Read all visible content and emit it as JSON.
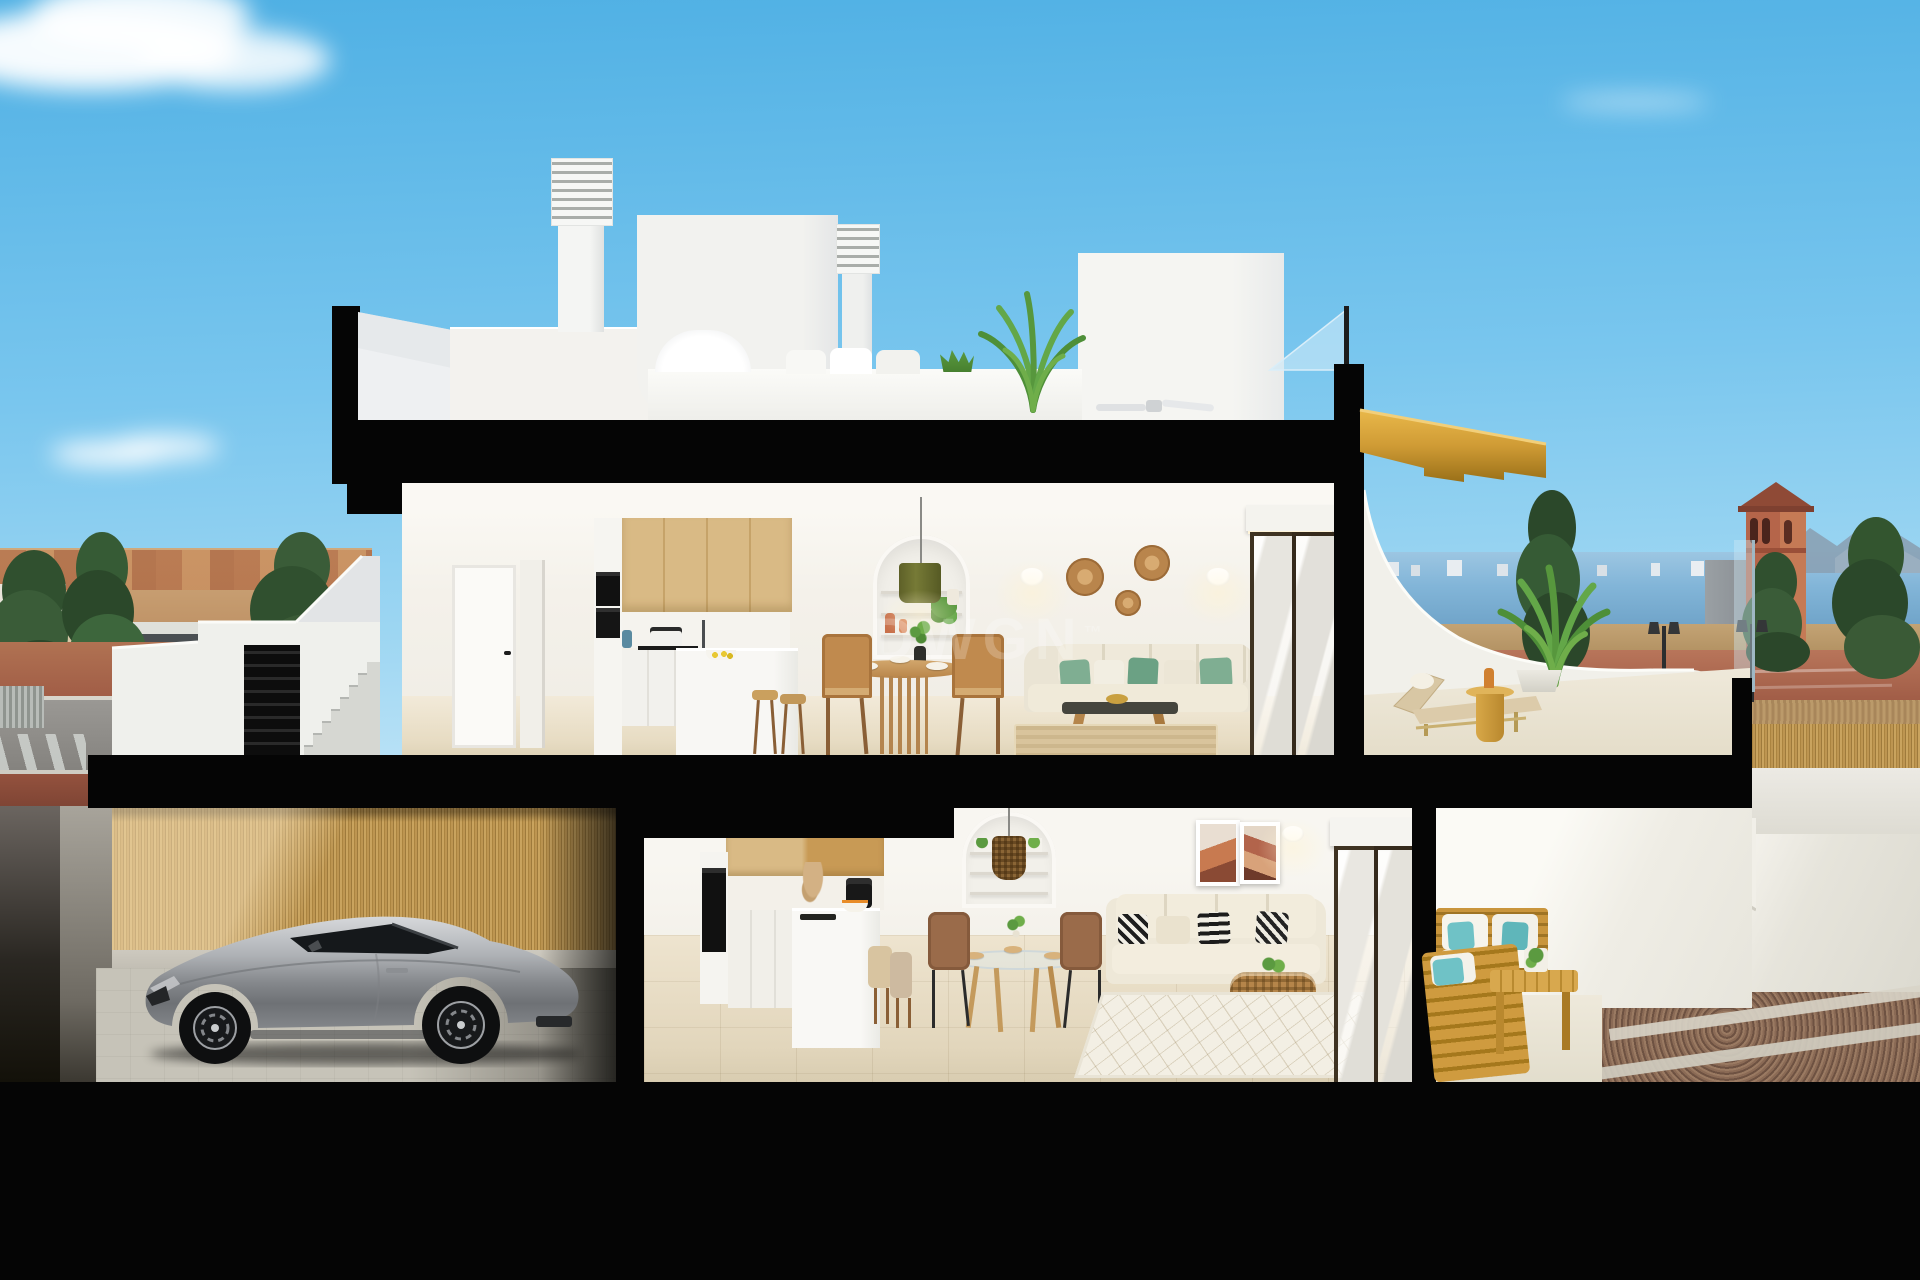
{
  "watermark": {
    "text": "DWGN",
    "tm": "™"
  },
  "palette": {
    "cut": "#050505",
    "sky-top": "#4fb0e4",
    "sky-mid": "#79c6ee",
    "sky-low": "#bfe4f7",
    "white": "#f3f2ee",
    "white-shade": "#e3e5e6",
    "wood": "#d9ba85",
    "gold": "#cf9b35",
    "gold-deep": "#a5781c",
    "floor-upper": "#ebe1cb",
    "floor-ground": "#e7dcc4",
    "garage-floor": "#c2bfb4",
    "sea": "#82b5d8",
    "town": "#c89a6c",
    "road-red": "#a05c46",
    "asphalt": "#94928e",
    "bamboo": "#c39a56",
    "teal": "#6fc2c6",
    "leaf": "#5b9a40",
    "terracotta": "#b2644b",
    "rattan": "#bd8a50",
    "car-silver": "#a7abaf"
  },
  "scene": {
    "type": "architectural-cutaway-render",
    "description": "Daylight cross-section render of a two-storey Mediterranean duplex: rooftop terrace with louvered chimneys, upper open-plan kitchen/dining/living with sun terrace and timber stair, ground-floor apartment with patio lounge, garage with silver sports coupe, coastal town, sea horizon and watchtower in the background",
    "levels": {
      "roof": [
        "louvered-chimney x2",
        "stair-bulkhead",
        "roof-terrace-parapet",
        "white-lounge-set",
        "potted-areca-palm",
        "ceiling-fan",
        "glass-balustrade"
      ],
      "upper": [
        "entry-hall-doors",
        "oak-kitchen-with-island",
        "bar-stools",
        "arched-shelf-niche",
        "olive-pendant-lamp",
        "round-timber-dining-table",
        "wicker-dining-chairs",
        "beige-sofa-green-pillows",
        "rattan-wall-plates",
        "wall-sconces",
        "dark-coffee-table",
        "jute-rug",
        "bronze-sliding-door",
        "sun-terrace",
        "sun-lounger",
        "gold-side-table",
        "potted-palm",
        "floating-timber-staircase"
      ],
      "ground": [
        "garage",
        "silver-sports-coupe",
        "bamboo-clad-wall",
        "oak-kitchen-with-island",
        "fruit-bowl",
        "coffee-machine",
        "arched-shelf-niche",
        "rattan-pendant-lamp",
        "glass-dining-table",
        "brown-dining-chairs",
        "beige-sofa-patterned-pillows",
        "abstract-art-pair",
        "rattan-basket-table",
        "diamond-rug",
        "bronze-sliding-door",
        "timber-patio-lounge-set",
        "teal-cushions",
        "gravel-garden"
      ]
    },
    "background": [
      "cumulus-clouds",
      "terracotta-town-skyline",
      "street-with-blue-sign",
      "conifer-trees",
      "sea-horizon",
      "distant-white-skyline",
      "mountains",
      "terracotta-watchtower",
      "twin-street-lamps",
      "bamboo-fence"
    ]
  }
}
